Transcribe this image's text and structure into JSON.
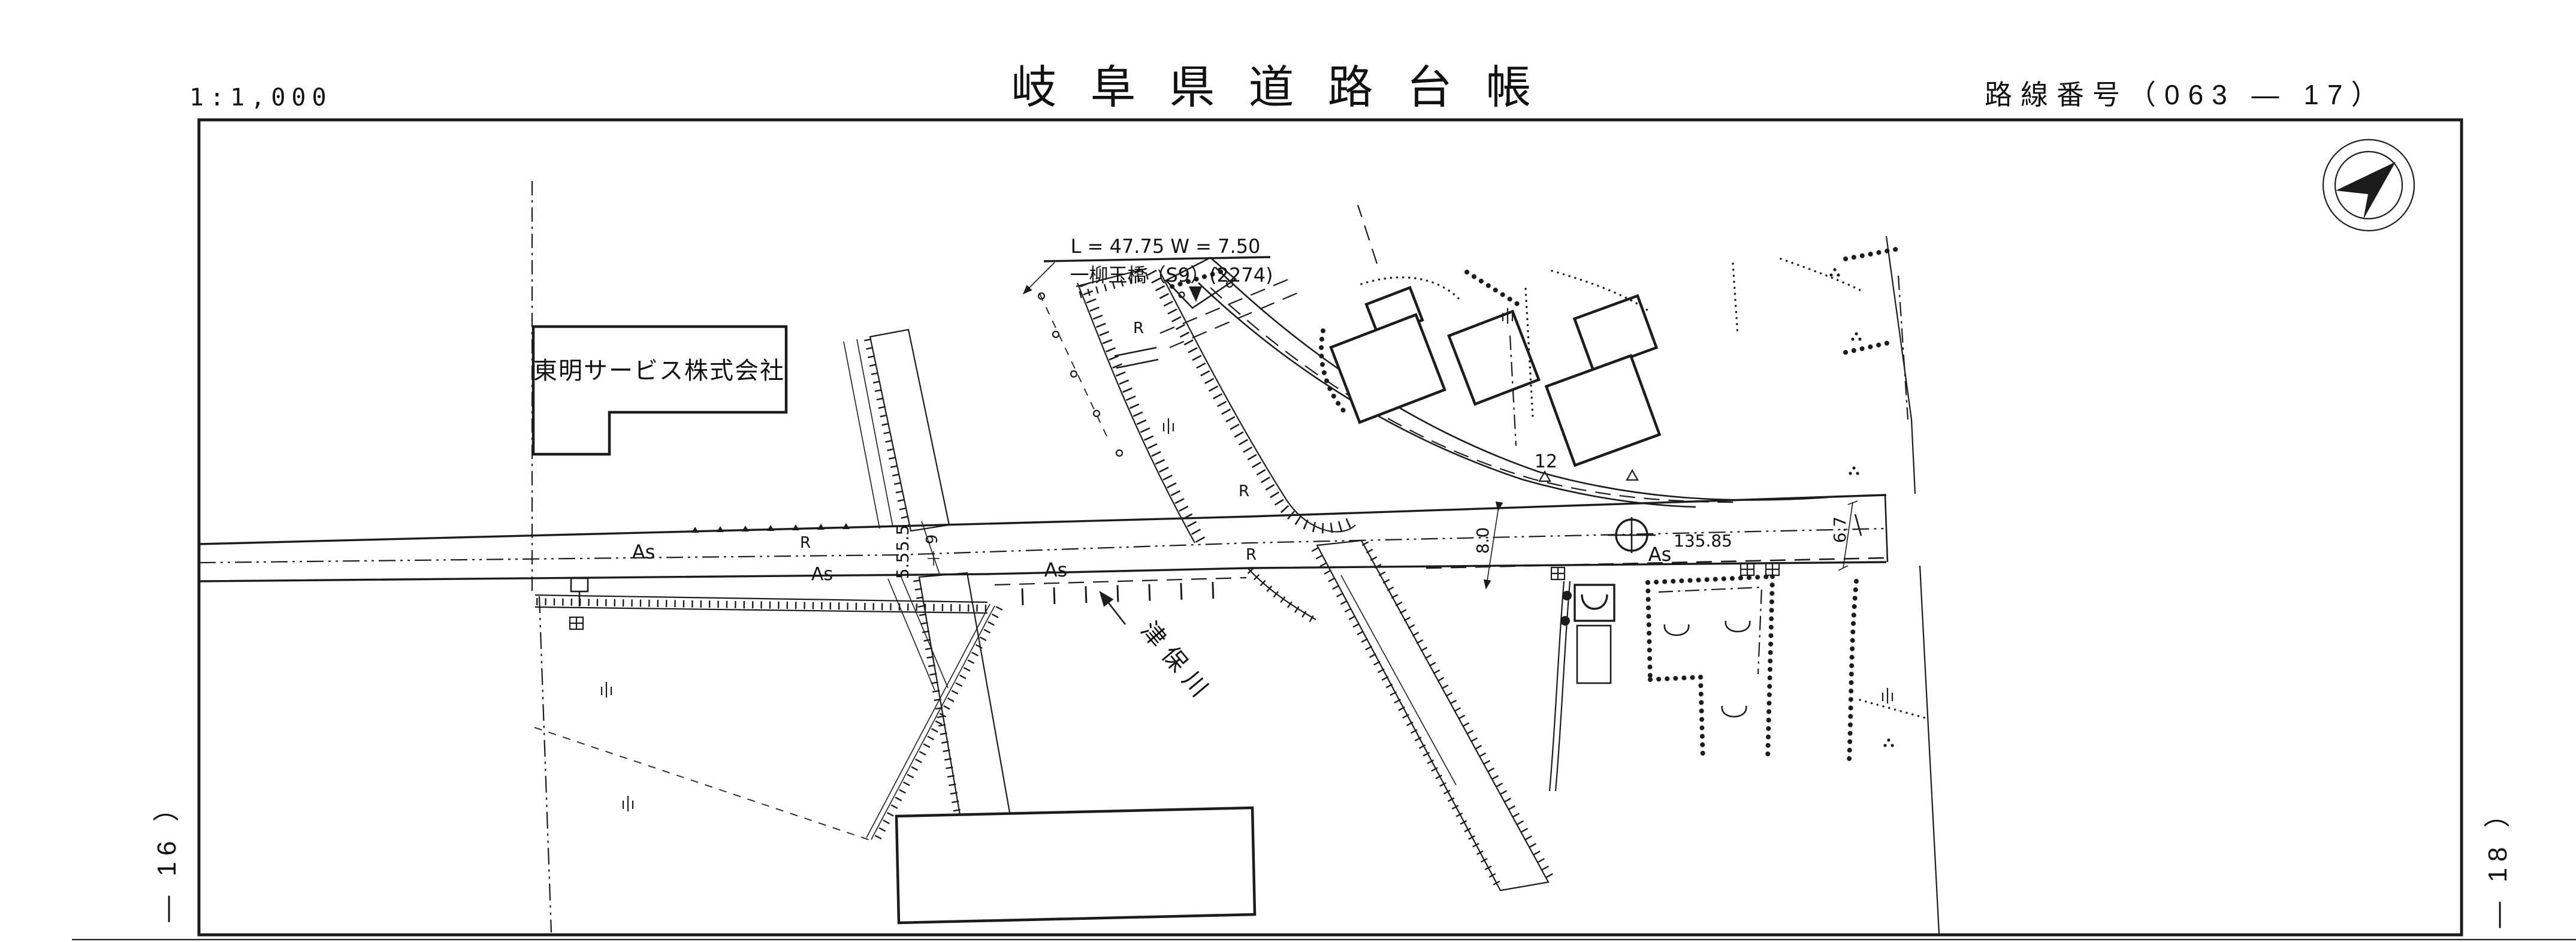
{
  "header": {
    "scale": "1:1,000",
    "title": "岐阜県道路台帳",
    "route": "路線番号（063 ― 17）"
  },
  "margins": {
    "left": "― 16 ）",
    "right": "― 18 ）"
  },
  "bridge": {
    "dims": "L = 47.75  W = 7.50",
    "name": "一柳玉橋（S9）(2274)"
  },
  "places": {
    "company": "東明サービス株式会社",
    "river": "津保川"
  },
  "surface": {
    "as": [
      "As",
      "As",
      "As",
      "As"
    ],
    "r": [
      "R",
      "R",
      "R",
      "R"
    ]
  },
  "dims": {
    "w55a": "5.5",
    "w55b": "5.5",
    "w9": "9",
    "w80": "8.0",
    "w67": "6.7",
    "station": "135.85",
    "parcel": "12"
  },
  "icons": {
    "compass": "north-arrow-compass",
    "benchmark": "benchmark-circle-cross"
  },
  "colors": {
    "ink": "#1c1c1c",
    "paper": "#ffffff"
  }
}
